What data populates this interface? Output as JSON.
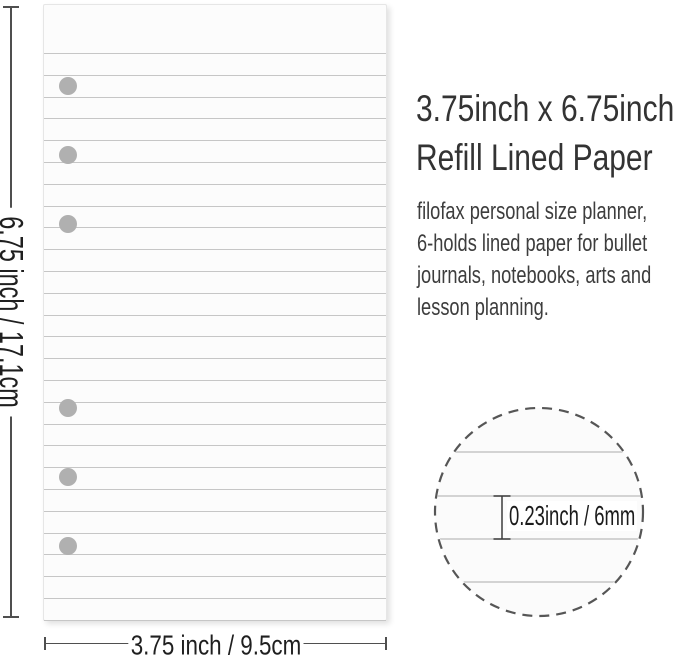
{
  "title": {
    "line1": "3.75inch x 6.75inch",
    "line2": "Refill Lined Paper"
  },
  "description": {
    "lines": [
      "filofax personal size planner,",
      "6-holds lined paper for bullet",
      "journals, notebooks, arts and",
      "lesson planning."
    ]
  },
  "measurements": {
    "height_label": "6.75 inch / 17.1cm",
    "width_label": "3.75 inch / 9.5cm",
    "line_spacing_label": "0.23inch / 6mm"
  },
  "paper": {
    "ruled_line_count": 27,
    "first_line_top": 48,
    "line_spacing": 21.8,
    "hole_count": 6,
    "hole_center_x": 24,
    "hole_radius": 9,
    "hole_centers_y": [
      81,
      150,
      219,
      403,
      472,
      541
    ]
  },
  "detail_circle": {
    "ruled_line_offsets": [
      46,
      90,
      133,
      176
    ]
  },
  "colors": {
    "paper_fill": "#fcfcfc",
    "ruled_line": "#c6c6c6",
    "hole": "#b0b0b0",
    "measure_line": "#4f4f4f",
    "dashed_circle": "#565656",
    "text_dark": "#333333"
  }
}
